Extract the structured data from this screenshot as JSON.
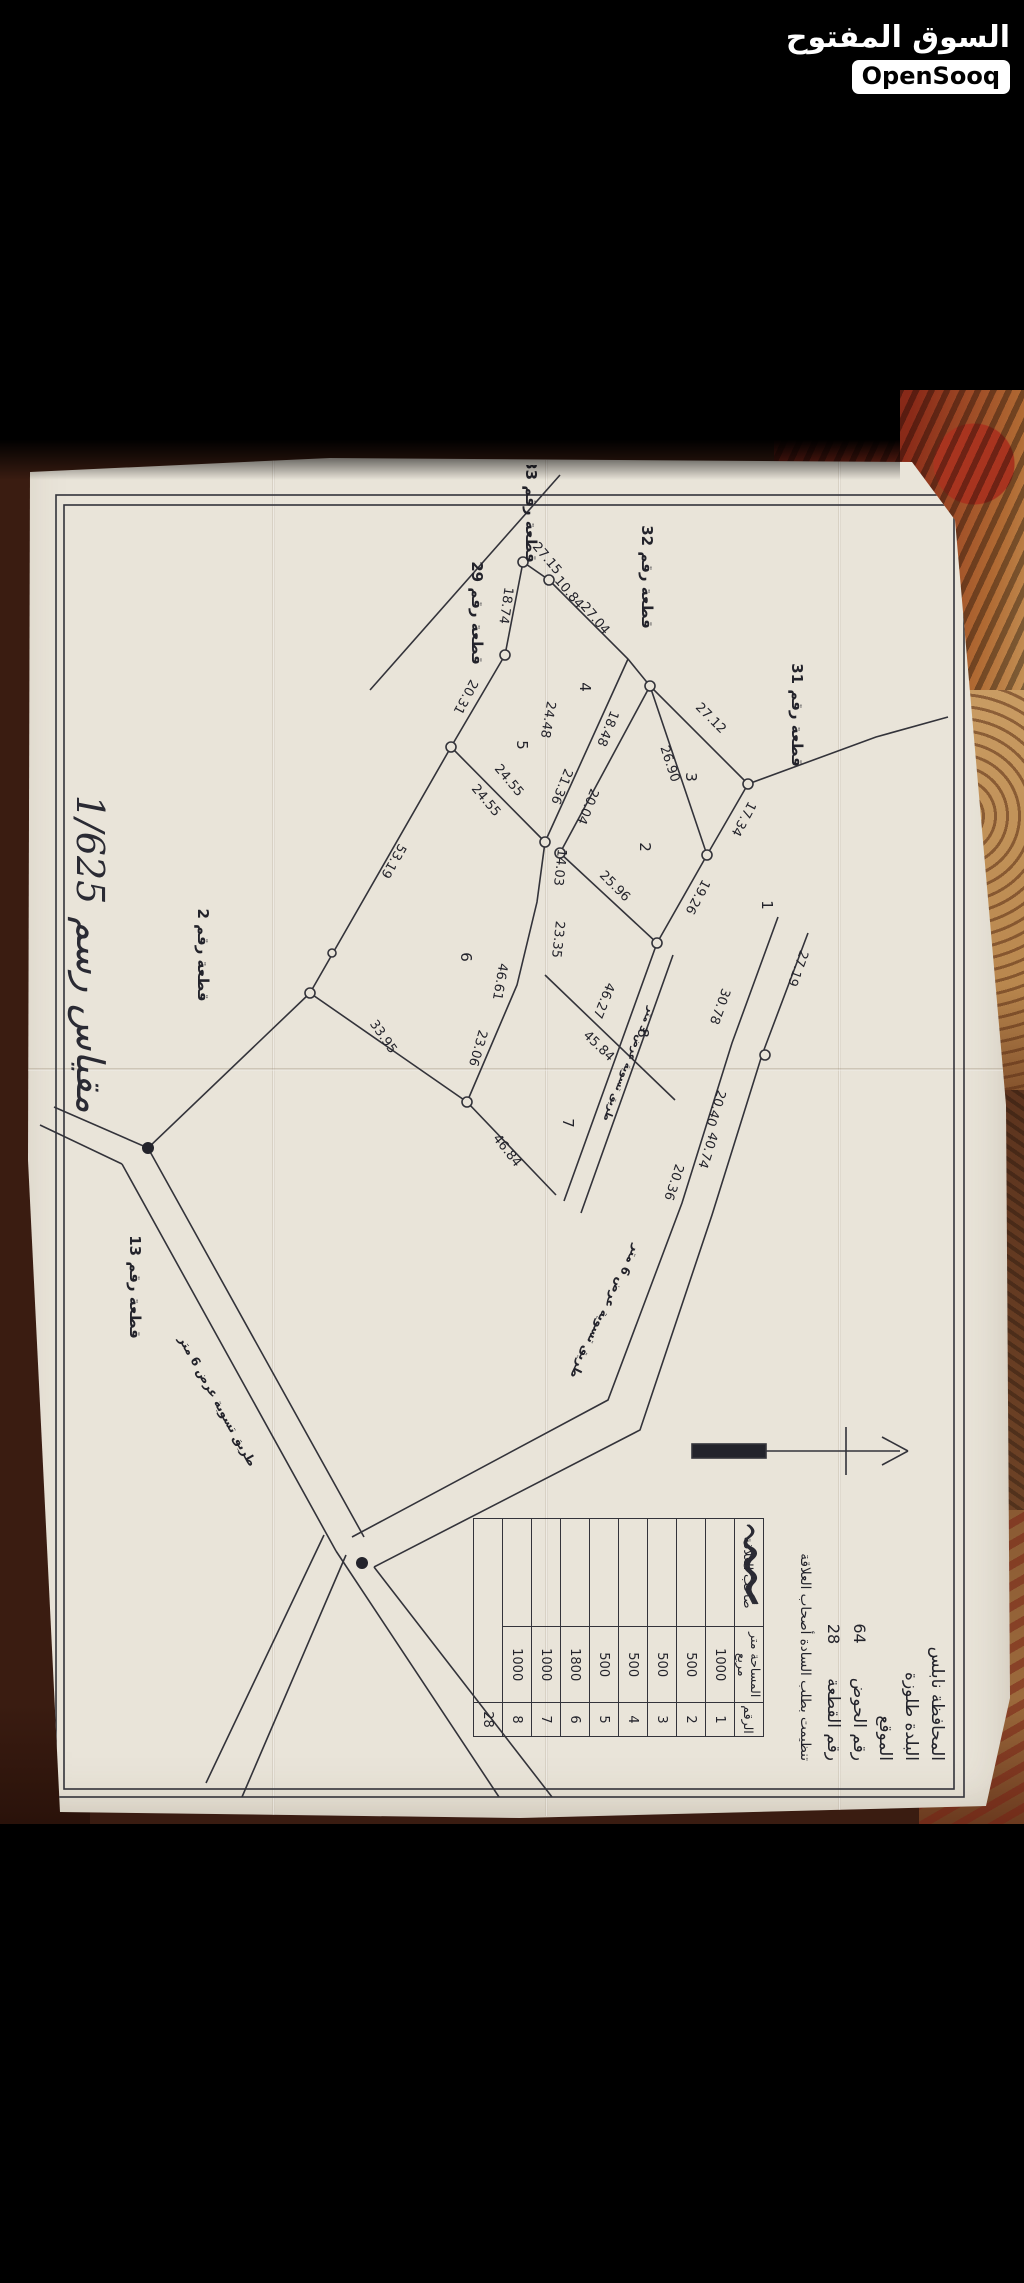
{
  "app": {
    "logo_title_ar": "السوق المفتوح",
    "logo_badge": "OpenSooq"
  },
  "plan": {
    "title_block": {
      "governorate_line": "المحافظة  نابلس",
      "town_line": "البلدة  طلوزة",
      "location_label": "الموقع",
      "basin_label": "رقم الحوض",
      "basin_value": "64",
      "parcel_label": "رقم القطعة",
      "parcel_value": "28",
      "note": "تنظيمت بطلب السادة أصحاب العلاقة"
    },
    "scale_text": "مقياس رسم 1/625",
    "north_arrow": "north-arrow",
    "table": {
      "headers": [
        "الرقم",
        "المساحة متر مربع",
        "صاحب العلاقة"
      ],
      "rows": [
        {
          "no": "1",
          "area": "1000"
        },
        {
          "no": "2",
          "area": "500"
        },
        {
          "no": "3",
          "area": "500"
        },
        {
          "no": "4",
          "area": "500"
        },
        {
          "no": "5",
          "area": "500"
        },
        {
          "no": "6",
          "area": "1800"
        },
        {
          "no": "7",
          "area": "1000"
        },
        {
          "no": "8",
          "area": "1000"
        }
      ],
      "footer_no": "28",
      "owners_note": "أسماء أصحاب العلاقة بخط اليد (غير مقروءة)"
    },
    "map": {
      "adjacent_plots": [
        {
          "t": "قطعة رقم 31",
          "x": 250,
          "y": 212
        },
        {
          "t": "قطعة رقم 32",
          "x": 112,
          "y": 362
        },
        {
          "t": "قطعة رقم 33",
          "x": 46,
          "y": 478
        },
        {
          "t": "قطعة رقم 29",
          "x": 148,
          "y": 532
        },
        {
          "t": "قطعة رقم 2",
          "x": 490,
          "y": 806
        },
        {
          "t": "قطعة رقم 13",
          "x": 822,
          "y": 874
        }
      ],
      "parcel_numbers": [
        {
          "t": "1",
          "x": 440,
          "y": 242
        },
        {
          "t": "2",
          "x": 382,
          "y": 364
        },
        {
          "t": "3",
          "x": 312,
          "y": 318
        },
        {
          "t": "4",
          "x": 222,
          "y": 424
        },
        {
          "t": "5",
          "x": 280,
          "y": 487
        },
        {
          "t": "6",
          "x": 492,
          "y": 543
        },
        {
          "t": "7",
          "x": 658,
          "y": 441
        },
        {
          "t": "8",
          "x": 568,
          "y": 366
        }
      ],
      "measurements": [
        {
          "v": "27.15",
          "x": 96,
          "y": 460,
          "r": -40
        },
        {
          "v": "10.84",
          "x": 130,
          "y": 438,
          "r": -40
        },
        {
          "v": "27.04",
          "x": 156,
          "y": 412,
          "r": -40
        },
        {
          "v": "18.74",
          "x": 140,
          "y": 502,
          "r": 8
        },
        {
          "v": "20.31",
          "x": 230,
          "y": 542,
          "r": 28
        },
        {
          "v": "24.55",
          "x": 318,
          "y": 498,
          "r": -40
        },
        {
          "v": "24.55",
          "x": 338,
          "y": 521,
          "r": -40
        },
        {
          "v": "24.48",
          "x": 254,
          "y": 460,
          "r": 10
        },
        {
          "v": "18.48",
          "x": 262,
          "y": 400,
          "r": 22
        },
        {
          "v": "21.36",
          "x": 320,
          "y": 446,
          "r": 22
        },
        {
          "v": "20.04",
          "x": 340,
          "y": 420,
          "r": 22
        },
        {
          "v": "27.12",
          "x": 256,
          "y": 296,
          "r": -45
        },
        {
          "v": "26.90",
          "x": 300,
          "y": 338,
          "r": -18
        },
        {
          "v": "17.34",
          "x": 352,
          "y": 264,
          "r": 28
        },
        {
          "v": "19.26",
          "x": 430,
          "y": 310,
          "r": 28
        },
        {
          "v": "25.96",
          "x": 424,
          "y": 392,
          "r": -45
        },
        {
          "v": "14.03",
          "x": 402,
          "y": 448,
          "r": 6
        },
        {
          "v": "23.35",
          "x": 474,
          "y": 450,
          "r": 6
        },
        {
          "v": "46.61",
          "x": 516,
          "y": 508,
          "r": 10
        },
        {
          "v": "23.06",
          "x": 582,
          "y": 530,
          "r": 16
        },
        {
          "v": "53.19",
          "x": 394,
          "y": 614,
          "r": 30
        },
        {
          "v": "33.95",
          "x": 574,
          "y": 624,
          "r": -35
        },
        {
          "v": "46.84",
          "x": 688,
          "y": 500,
          "r": -38
        },
        {
          "v": "45.84",
          "x": 584,
          "y": 408,
          "r": -46
        },
        {
          "v": "46.27",
          "x": 534,
          "y": 404,
          "r": 22
        },
        {
          "v": "30.78",
          "x": 540,
          "y": 288,
          "r": 20
        },
        {
          "v": "27.19",
          "x": 502,
          "y": 210,
          "r": 20
        },
        {
          "v": "20.40",
          "x": 642,
          "y": 292,
          "r": 18
        },
        {
          "v": "40.74",
          "x": 684,
          "y": 300,
          "r": 18
        },
        {
          "v": "20.36",
          "x": 716,
          "y": 334,
          "r": 18
        }
      ],
      "road_labels": [
        {
          "t": "طريق تسوية عرض 6 متر",
          "x": 845,
          "y": 402,
          "r": 26,
          "small": false
        },
        {
          "t": "طريق تسوية عرض 6 متر",
          "x": 938,
          "y": 790,
          "r": -29,
          "small": false
        },
        {
          "t": "طريق تسوية عرض 3 متر",
          "x": 598,
          "y": 378,
          "r": 22,
          "small": true
        }
      ]
    }
  }
}
